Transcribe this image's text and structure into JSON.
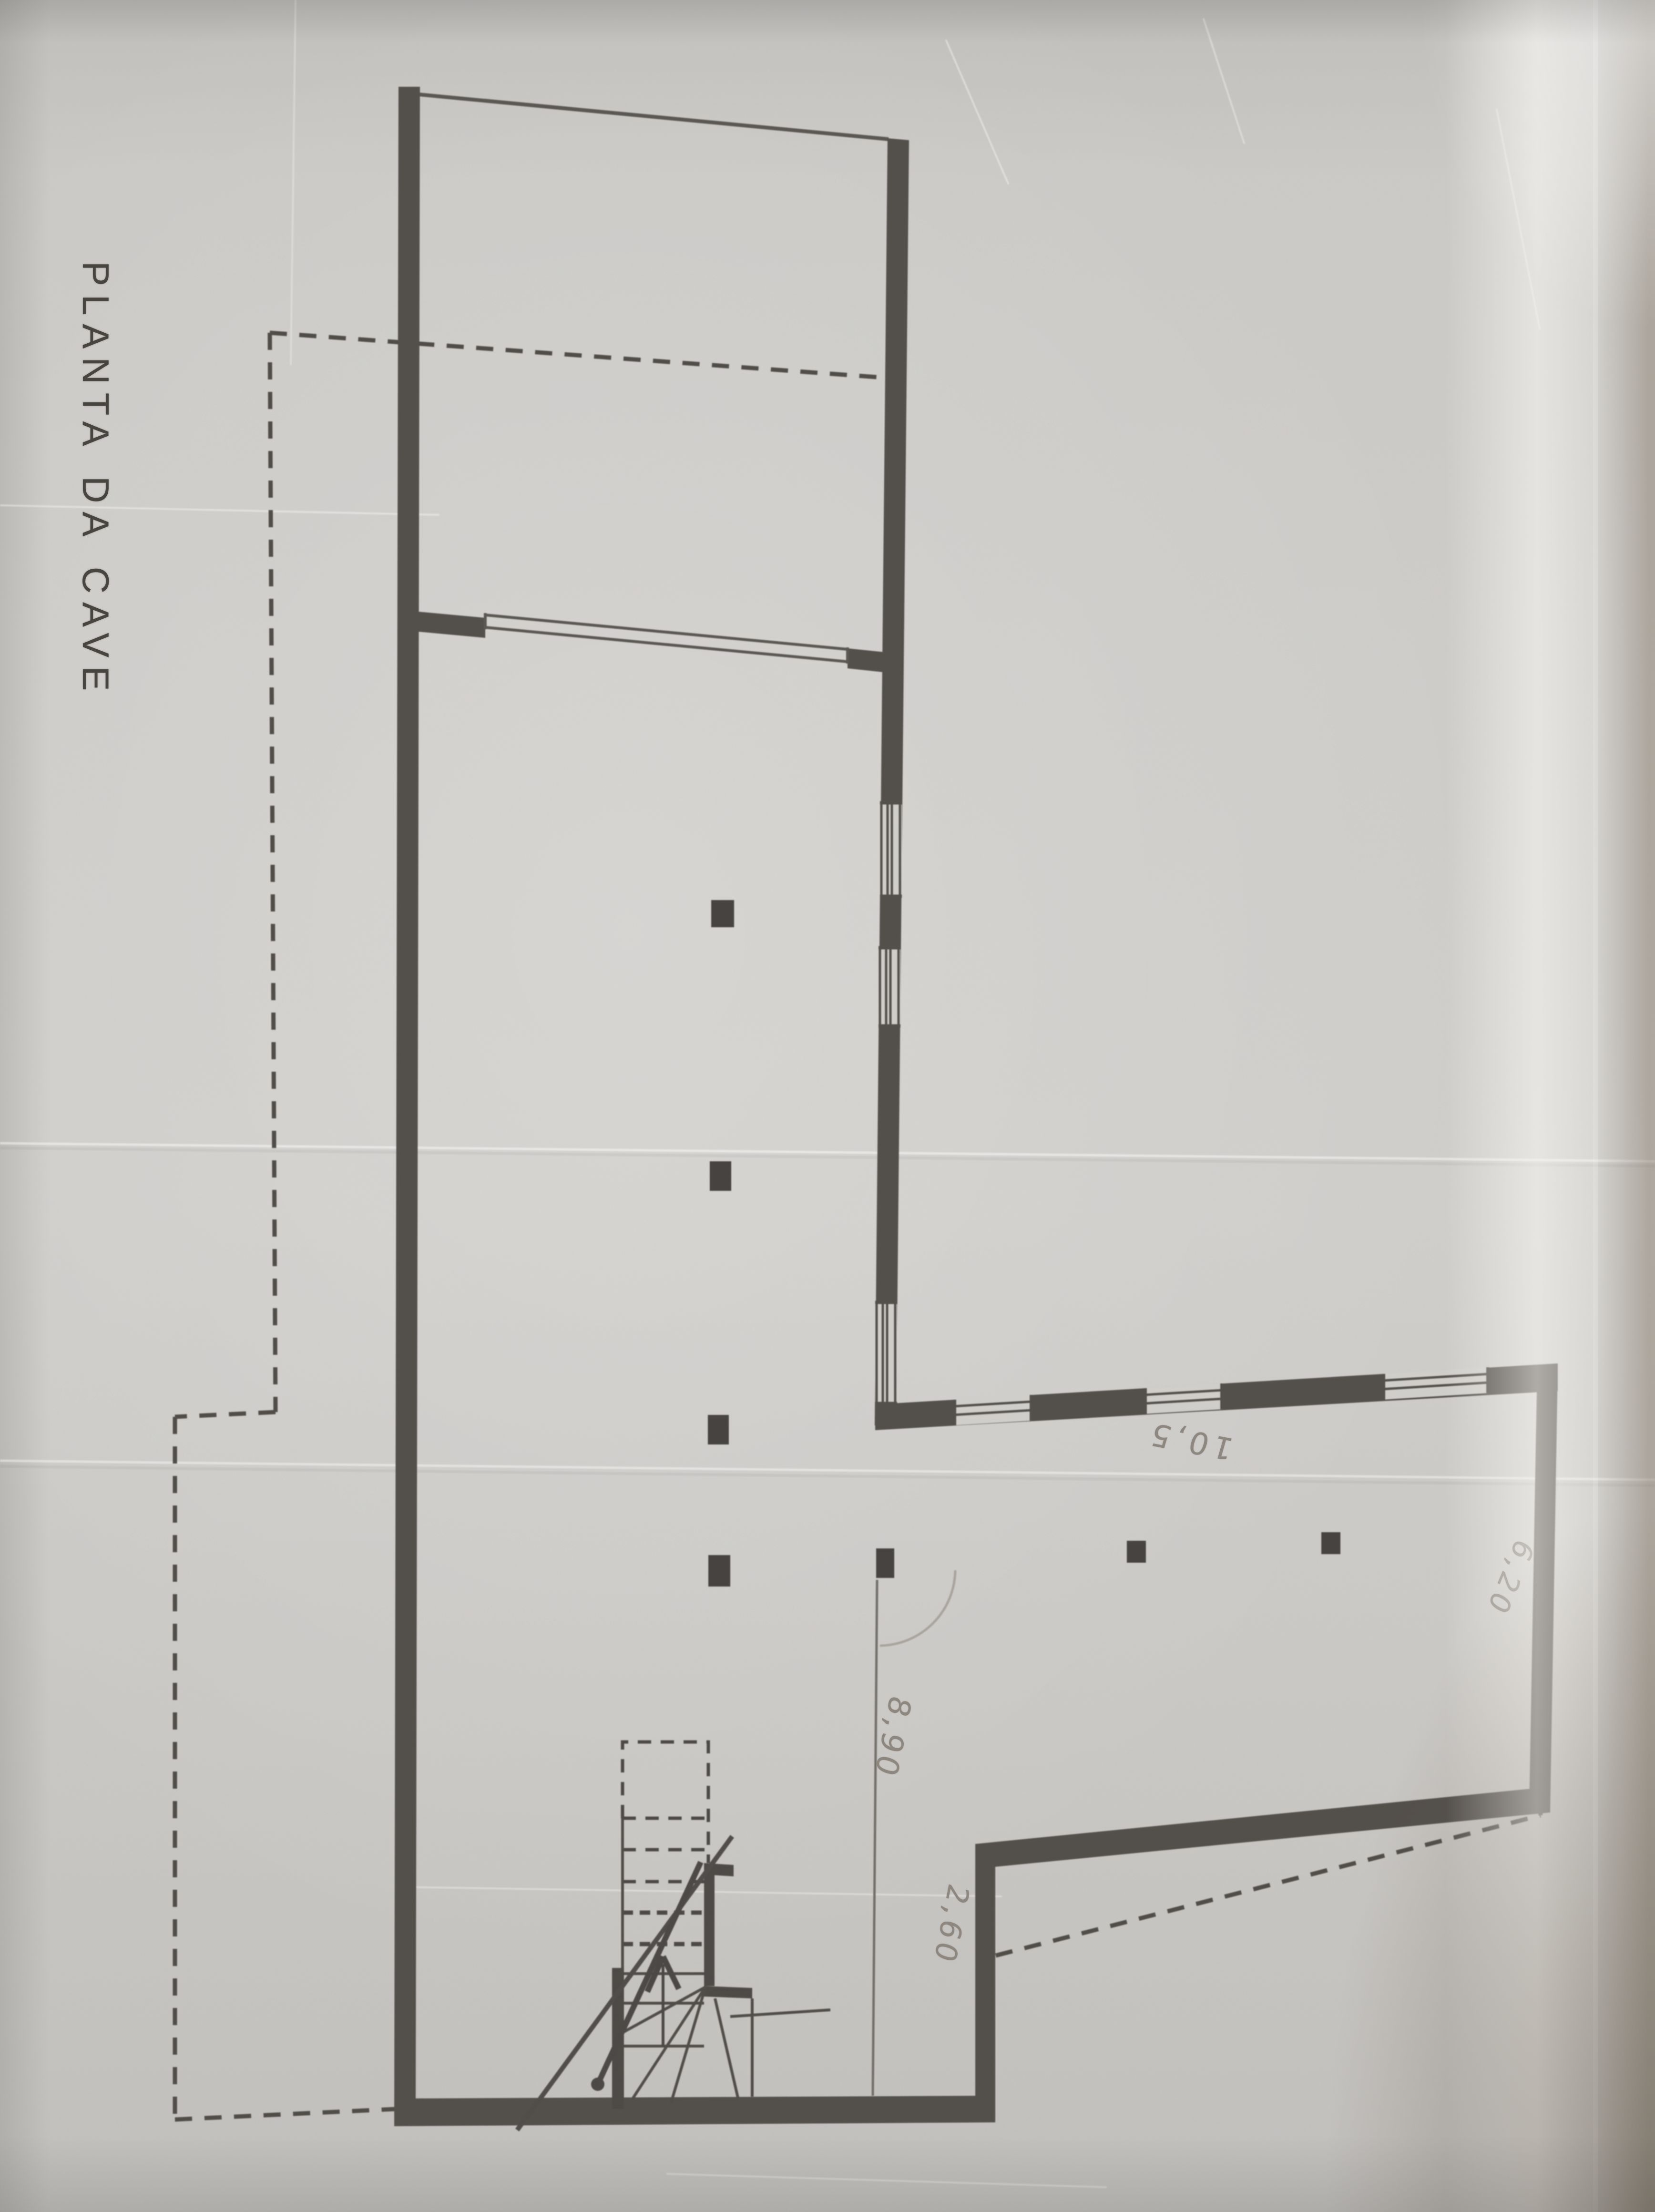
{
  "plan": {
    "title": "PLANTA DA CAVE",
    "dimensions": {
      "hall_depth": "8,90",
      "step_offset": "2,60",
      "room_width": "10,5",
      "room_depth": "6,20"
    }
  }
}
